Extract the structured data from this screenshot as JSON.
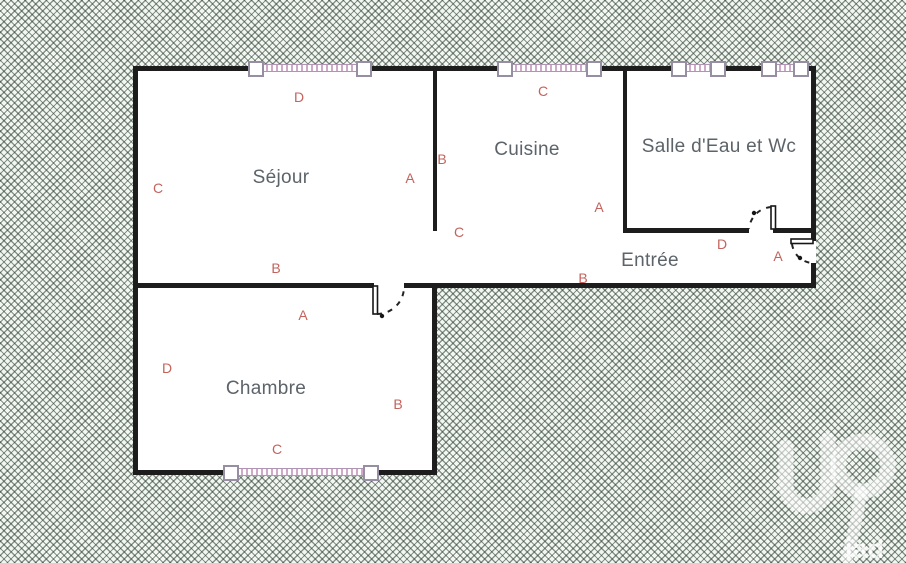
{
  "plan": {
    "colors": {
      "background": "#f3f7f2",
      "hatch_line": "#2c3e33",
      "wall": "#1d1d1d",
      "room_text": "#5c646a",
      "marker_text": "#c4635d",
      "window": "#cfa9ca",
      "floor": "#ffffff"
    },
    "rooms": [
      {
        "name": "Séjour",
        "x": 281,
        "y": 178
      },
      {
        "name": "Cuisine",
        "x": 527,
        "y": 150
      },
      {
        "name": "Salle d'Eau et Wc",
        "x": 719,
        "y": 147
      },
      {
        "name": "Entrée",
        "x": 650,
        "y": 261
      },
      {
        "name": "Chambre",
        "x": 266,
        "y": 389
      }
    ],
    "markers": [
      {
        "text": "D",
        "x": 299,
        "y": 97
      },
      {
        "text": "C",
        "x": 158,
        "y": 188
      },
      {
        "text": "A",
        "x": 410,
        "y": 178
      },
      {
        "text": "B",
        "x": 442,
        "y": 159
      },
      {
        "text": "C",
        "x": 543,
        "y": 91
      },
      {
        "text": "C",
        "x": 459,
        "y": 232
      },
      {
        "text": "A",
        "x": 599,
        "y": 207
      },
      {
        "text": "D",
        "x": 722,
        "y": 244
      },
      {
        "text": "A",
        "x": 778,
        "y": 256
      },
      {
        "text": "B",
        "x": 583,
        "y": 278
      },
      {
        "text": "B",
        "x": 276,
        "y": 268
      },
      {
        "text": "A",
        "x": 303,
        "y": 315
      },
      {
        "text": "D",
        "x": 167,
        "y": 368
      },
      {
        "text": "B",
        "x": 398,
        "y": 404
      },
      {
        "text": "C",
        "x": 277,
        "y": 449
      }
    ],
    "logo": {
      "text": "iad"
    }
  }
}
